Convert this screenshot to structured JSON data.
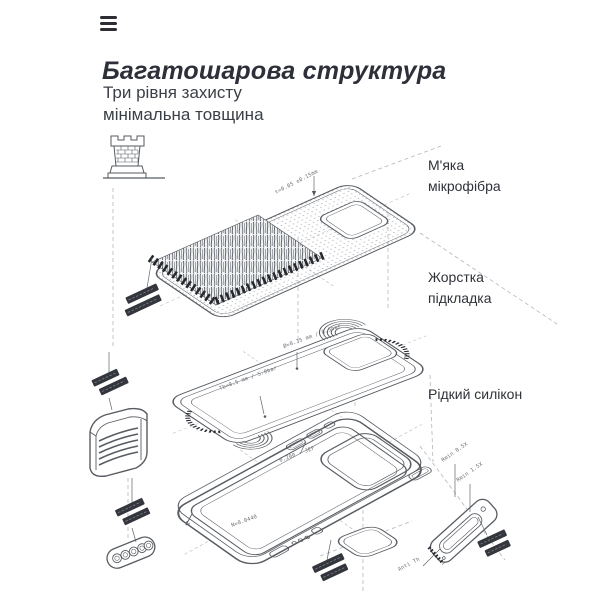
{
  "header": {
    "title": "Багатошарова структура",
    "subtitle_line1": "Три рівня захисту",
    "subtitle_line2": "мінімальна товщина"
  },
  "icons": {
    "menu": "hamburger-icon",
    "protection": "castle-tower-icon"
  },
  "colors": {
    "background": "#ffffff",
    "title_text": "#2e3039",
    "body_text": "#3b3f46",
    "line_art": "#585c62",
    "dashed_lines": "#aeb2b8",
    "dark_marks": "#26282d"
  },
  "diagram": {
    "type": "exploded-phone-case-layers",
    "layers": [
      {
        "name": "microfiber",
        "label": "М'яка мікрофібра"
      },
      {
        "name": "hard-lining",
        "label": "Жорстка підкладка"
      },
      {
        "name": "liquid-silicone",
        "label": "Рідкий силікон"
      }
    ],
    "annotations": {
      "thickness_top": "t=0.05 ±0.15mm",
      "dim_mid_1": "Ø=0.35 mm / 0.5bar",
      "dim_mid_2": "Tb=0.5 mm / 5.0bar",
      "dim_case_1": "0.200 - JEF",
      "dim_case_2": "N=0.0440",
      "rmin_1": "Rmin 0.5X",
      "rmin_2": "Rmin 1.5X",
      "anti": "Anti Th"
    }
  }
}
